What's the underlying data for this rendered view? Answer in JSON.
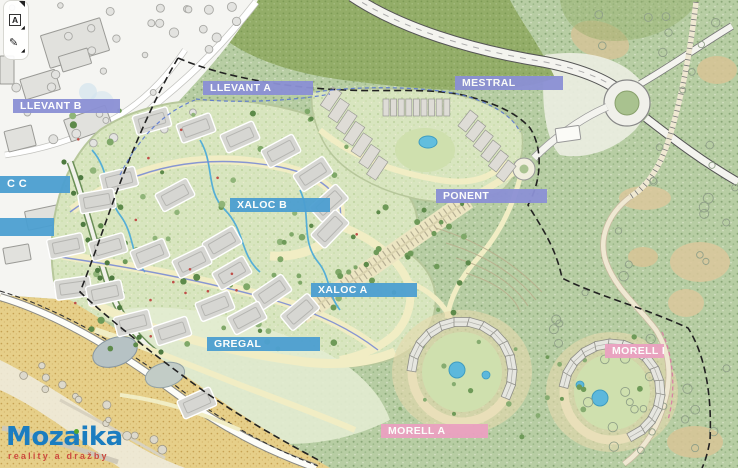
{
  "zones": {
    "llevant_a": "LLEVANT A",
    "llevant_b": "LLEVANT B",
    "mestral": "MESTRAL",
    "ponent": "PONENT",
    "xaloc_b": "XALOC B",
    "xaloc_a": "XALOC A",
    "gregal": "GREGAL",
    "morell_a": "MORELL A",
    "morell_b": "MORELL B",
    "partial_label": "C C"
  },
  "brand": {
    "name": "Mozaika",
    "tagline": "reality a dražby"
  },
  "toolbar": {
    "text_annotation": "A",
    "draw_annotation": "✎"
  },
  "colors": {
    "zone_purple": "#8b90d5",
    "zone_blue": "#4c9fd1",
    "zone_pink": "#eba1c1",
    "brand_blue": "#1b7dc0",
    "brand_red": "#cc4a3e",
    "brand_green": "#56a52c"
  }
}
